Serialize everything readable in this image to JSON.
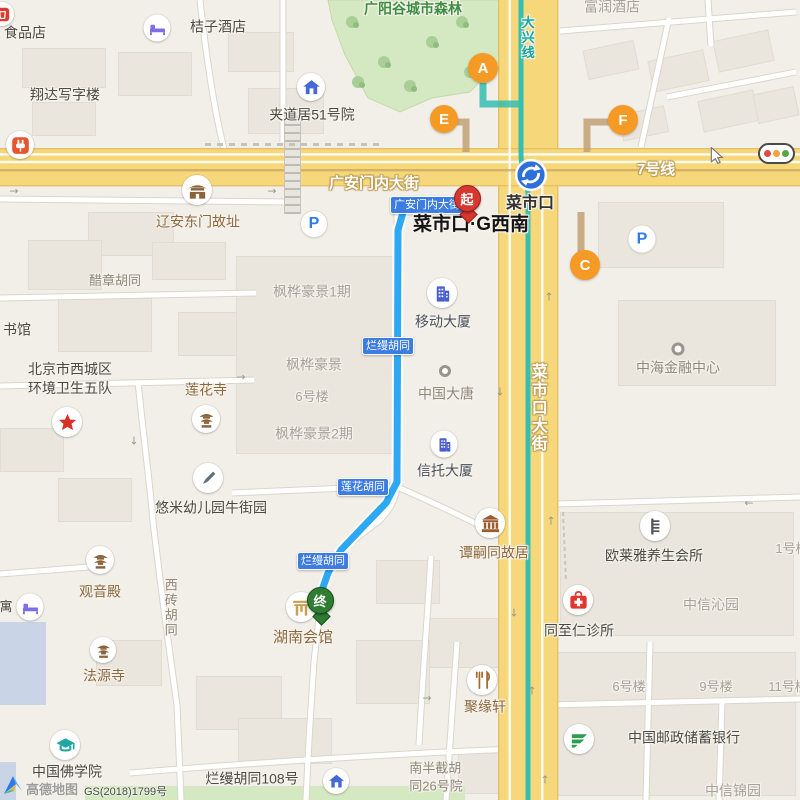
{
  "colors": {
    "road_fill": "#F6D87A",
    "road_edge": "#E5C068",
    "street_fill": "#FFFFFF",
    "street_case": "#DAD6CC",
    "metro_teal": "#2BBDB3",
    "line7_tan": "#C9A463",
    "route_blue": "#2EA8F2",
    "exit_orange": "#F59B25",
    "badge_blue": "#3D7CE0",
    "park_green": "#D4E8C2",
    "start_pin_red": "#D6372E",
    "end_pin_green": "#2E7D32"
  },
  "roads": {
    "h_name": "广安门内大街",
    "v_name": "菜市口大街",
    "line7_label": "7号线",
    "daxing_label": "大兴线"
  },
  "station": {
    "name": "菜市口",
    "label_x": 530,
    "label_y": 204,
    "icon_x": 531,
    "icon_y": 175,
    "icon_d": 33
  },
  "route": {
    "start_pin_label": "起",
    "end_pin_label": "终",
    "start_poi": "菜市口·G西南",
    "end_poi": "湖南会馆",
    "polyline": [
      [
        464,
        211
      ],
      [
        404,
        209
      ],
      [
        398,
        230
      ],
      [
        397,
        482
      ],
      [
        386,
        503
      ],
      [
        362,
        528
      ],
      [
        341,
        550
      ],
      [
        328,
        573
      ],
      [
        321,
        593
      ],
      [
        320,
        603
      ]
    ],
    "pins": [
      {
        "label": "起",
        "x": 467,
        "tip": 221,
        "fill": "#D6372E",
        "edge": "#9E1F16",
        "name": "start-pin"
      },
      {
        "label": "终",
        "x": 320,
        "tip": 623,
        "fill": "#2E7D32",
        "edge": "#175219",
        "name": "end-pin"
      }
    ]
  },
  "badges": [
    {
      "text": "广安门内大街",
      "x": 390,
      "y": 196,
      "w": 70
    },
    {
      "text": "烂缦胡同",
      "x": 362,
      "y": 337,
      "w": 0
    },
    {
      "text": "莲花胡同",
      "x": 337,
      "y": 478,
      "w": 0
    },
    {
      "text": "烂缦胡同",
      "x": 297,
      "y": 552,
      "w": 0
    }
  ],
  "exits": [
    {
      "letter": "A",
      "x": 483,
      "y": 68,
      "d": 30
    },
    {
      "letter": "E",
      "x": 444,
      "y": 119,
      "d": 28
    },
    {
      "letter": "F",
      "x": 623,
      "y": 120,
      "d": 30
    },
    {
      "letter": "C",
      "x": 585,
      "y": 265,
      "d": 30
    }
  ],
  "parkings": [
    {
      "x": 314,
      "y": 224,
      "d": 26
    },
    {
      "x": 642,
      "y": 239,
      "d": 27
    }
  ],
  "labels": [
    {
      "t": "食品店",
      "x": 25,
      "y": 33,
      "c": "dark",
      "s": 14,
      "i": true
    },
    {
      "t": "桔子酒店",
      "x": 218,
      "y": 27,
      "c": "dark",
      "s": 14,
      "i": true
    },
    {
      "t": "翔达写字楼",
      "x": 65,
      "y": 95,
      "c": "dark",
      "s": 14,
      "i": true
    },
    {
      "t": "夹道居51号院",
      "x": 312,
      "y": 115,
      "c": "dark",
      "s": 14,
      "i": true
    },
    {
      "t": "广阳谷城市森林",
      "x": 413,
      "y": 9,
      "c": "green",
      "s": 14,
      "i": true
    },
    {
      "t": "富润酒店",
      "x": 612,
      "y": 7,
      "c": "light",
      "s": 14,
      "i": true
    },
    {
      "t": "辽安东门故址",
      "x": 198,
      "y": 222,
      "c": "brown",
      "s": 14,
      "i": true
    },
    {
      "t": "醋章胡同",
      "x": 115,
      "y": 281,
      "c": "warm",
      "s": 13,
      "i": false
    },
    {
      "t": "书馆",
      "x": 17,
      "y": 330,
      "c": "dark",
      "s": 14,
      "i": true
    },
    {
      "t": "北京市西城区\n环境卫生五队",
      "x": 70,
      "y": 379,
      "c": "dark",
      "s": 14,
      "i": true
    },
    {
      "t": "莲花寺",
      "x": 206,
      "y": 390,
      "c": "brown",
      "s": 14,
      "i": true
    },
    {
      "t": "枫桦豪景1期",
      "x": 312,
      "y": 292,
      "c": "light",
      "s": 14,
      "i": true
    },
    {
      "t": "移动大厦",
      "x": 443,
      "y": 322,
      "c": "slate",
      "s": 14,
      "i": true
    },
    {
      "t": "枫桦豪景",
      "x": 314,
      "y": 365,
      "c": "light",
      "s": 14,
      "i": true
    },
    {
      "t": "6号楼",
      "x": 312,
      "y": 397,
      "c": "light",
      "s": 13,
      "i": false
    },
    {
      "t": "中国大唐",
      "x": 446,
      "y": 394,
      "c": "warm",
      "s": 14,
      "i": true
    },
    {
      "t": "枫桦豪景2期",
      "x": 314,
      "y": 434,
      "c": "light",
      "s": 14,
      "i": true
    },
    {
      "t": "信托大厦",
      "x": 445,
      "y": 471,
      "c": "slate",
      "s": 14,
      "i": true
    },
    {
      "t": "中海金融中心",
      "x": 678,
      "y": 368,
      "c": "warm",
      "s": 14,
      "i": true
    },
    {
      "t": "悠米幼儿园牛街园",
      "x": 211,
      "y": 508,
      "c": "dark",
      "s": 14,
      "i": true
    },
    {
      "t": "谭嗣同故居",
      "x": 494,
      "y": 553,
      "c": "brown",
      "s": 14,
      "i": true
    },
    {
      "t": "欧莱雅养生会所",
      "x": 654,
      "y": 556,
      "c": "dark",
      "s": 14,
      "i": true
    },
    {
      "t": "同至仁诊所",
      "x": 579,
      "y": 631,
      "c": "dark",
      "s": 14,
      "i": true
    },
    {
      "t": "中信沁园",
      "x": 711,
      "y": 605,
      "c": "light",
      "s": 14,
      "i": true
    },
    {
      "t": "观音殿",
      "x": 100,
      "y": 592,
      "c": "brown",
      "s": 14,
      "i": true
    },
    {
      "t": "法源寺",
      "x": 104,
      "y": 676,
      "c": "brown",
      "s": 14,
      "i": true
    },
    {
      "t": "寓",
      "x": 6,
      "y": 607,
      "c": "dark",
      "s": 13,
      "i": true
    },
    {
      "t": "湖南会馆",
      "x": 303,
      "y": 638,
      "c": "brown",
      "s": 15,
      "i": true
    },
    {
      "t": "聚缘轩",
      "x": 485,
      "y": 707,
      "c": "brown",
      "s": 14,
      "i": true
    },
    {
      "t": "6号楼",
      "x": 629,
      "y": 687,
      "c": "light",
      "s": 13,
      "i": false
    },
    {
      "t": "9号楼",
      "x": 716,
      "y": 687,
      "c": "light",
      "s": 13,
      "i": false
    },
    {
      "t": "11号楼",
      "x": 788,
      "y": 687,
      "c": "light",
      "s": 13,
      "i": false
    },
    {
      "t": "中国邮政储蓄银行",
      "x": 684,
      "y": 738,
      "c": "dark",
      "s": 14,
      "i": true
    },
    {
      "t": "中信锦园",
      "x": 733,
      "y": 791,
      "c": "light",
      "s": 14,
      "i": true
    },
    {
      "t": "中国佛学院",
      "x": 67,
      "y": 772,
      "c": "dark",
      "s": 14,
      "i": true
    },
    {
      "t": "烂缦胡同108号",
      "x": 252,
      "y": 779,
      "c": "dark",
      "s": 14,
      "i": true
    },
    {
      "t": "南半截胡\n同26号院",
      "x": 436,
      "y": 777,
      "c": "warm",
      "s": 13,
      "i": false
    },
    {
      "t": "1号楼",
      "x": 792,
      "y": 549,
      "c": "light",
      "s": 13,
      "i": false
    },
    {
      "t": "西砖胡同",
      "x": 170,
      "y": 608,
      "c": "warm",
      "s": 13,
      "v": true,
      "i": false
    },
    {
      "t": "菜市口·G西南",
      "x": 471,
      "y": 225,
      "c": "black",
      "s": 19,
      "i": true
    },
    {
      "t": "菜市口",
      "x": 530,
      "y": 204,
      "c": "station",
      "s": 16,
      "i": true
    },
    {
      "t": "广安门内大街",
      "x": 374,
      "y": 184,
      "c": "roadwhite",
      "s": 15,
      "i": false
    },
    {
      "t": "7号线",
      "x": 656,
      "y": 170,
      "c": "roadwhite",
      "s": 15,
      "i": false
    },
    {
      "t": "菜市口大街",
      "x": 537,
      "y": 408,
      "c": "roadwhite",
      "s": 16,
      "v": true,
      "i": false
    },
    {
      "t": "大兴线",
      "x": 527,
      "y": 38,
      "c": "teal",
      "s": 13,
      "v": true,
      "i": false
    }
  ],
  "icons": [
    {
      "t": "shopred",
      "x": 2,
      "y": 14,
      "d": 24
    },
    {
      "t": "bed",
      "x": 157,
      "y": 28,
      "d": 27
    },
    {
      "t": "houseblue",
      "x": 311,
      "y": 87,
      "d": 28
    },
    {
      "t": "plug",
      "x": 20,
      "y": 145,
      "d": 28
    },
    {
      "t": "gate",
      "x": 197,
      "y": 190,
      "d": 30
    },
    {
      "t": "building",
      "x": 442,
      "y": 293,
      "d": 30
    },
    {
      "t": "building",
      "x": 444,
      "y": 444,
      "d": 27
    },
    {
      "t": "dot",
      "x": 445,
      "y": 371,
      "d": 12
    },
    {
      "t": "dot",
      "x": 678,
      "y": 349,
      "d": 13
    },
    {
      "t": "star",
      "x": 67,
      "y": 422,
      "d": 30
    },
    {
      "t": "pagoda",
      "x": 206,
      "y": 419,
      "d": 28
    },
    {
      "t": "pencil",
      "x": 208,
      "y": 478,
      "d": 30
    },
    {
      "t": "pagoda",
      "x": 100,
      "y": 560,
      "d": 28
    },
    {
      "t": "bed",
      "x": 30,
      "y": 607,
      "d": 27
    },
    {
      "t": "pagoda",
      "x": 103,
      "y": 650,
      "d": 26
    },
    {
      "t": "paifang",
      "x": 301,
      "y": 607,
      "d": 30
    },
    {
      "t": "museum",
      "x": 490,
      "y": 523,
      "d": 30
    },
    {
      "t": "comb",
      "x": 655,
      "y": 526,
      "d": 30
    },
    {
      "t": "medical",
      "x": 578,
      "y": 600,
      "d": 30
    },
    {
      "t": "restaurant",
      "x": 482,
      "y": 680,
      "d": 30
    },
    {
      "t": "post",
      "x": 579,
      "y": 739,
      "d": 30
    },
    {
      "t": "gradcap",
      "x": 65,
      "y": 745,
      "d": 30
    },
    {
      "t": "houseblue",
      "x": 336,
      "y": 781,
      "d": 26
    }
  ],
  "arrows": [
    {
      "x": 14,
      "y": 191,
      "g": "→"
    },
    {
      "x": 272,
      "y": 191,
      "g": "→"
    },
    {
      "x": 241,
      "y": 377,
      "g": "→"
    },
    {
      "x": 134,
      "y": 441,
      "g": "↓"
    },
    {
      "x": 549,
      "y": 297,
      "g": "↑"
    },
    {
      "x": 500,
      "y": 392,
      "g": "↓"
    },
    {
      "x": 514,
      "y": 613,
      "g": "↓"
    },
    {
      "x": 551,
      "y": 521,
      "g": "↑"
    },
    {
      "x": 427,
      "y": 698,
      "g": "→"
    },
    {
      "x": 532,
      "y": 691,
      "g": "↑"
    },
    {
      "x": 545,
      "y": 780,
      "g": "↑"
    },
    {
      "x": 749,
      "y": 503,
      "g": "←"
    }
  ],
  "geometry": {
    "h_road": {
      "y": 149,
      "h": 36
    },
    "v_road": {
      "x": 499,
      "w": 58
    },
    "metro_line_d": "M521,0 L521,155 C521,172 528,178 528,195 L528,800",
    "line7_y": 169,
    "connectors": [
      {
        "d": "M446,122 H466 V152",
        "c": "tan"
      },
      {
        "d": "M620,122 H587 V152",
        "c": "tan"
      },
      {
        "d": "M581,212 V252",
        "c": "tan"
      },
      {
        "d": "M483,70 V104 H519",
        "c": "teal"
      }
    ],
    "streets": [
      "M200,0 C206,55 213,105 224,149",
      "M283,0 L283,142",
      "M0,199 L288,202",
      "M0,298 L256,293",
      "M0,386 L254,380",
      "M138,382 C145,450 150,485 153,521 C161,590 170,655 177,705 L181,800",
      "M232,493 L395,486",
      "M395,486 C432,502 472,521 506,539",
      "M397,207 L397,482 C397,499 389,511 379,521 L342,549 C333,560 325,574 322,591 L314,662 C311,705 308,755 306,800",
      "M556,504 L800,497",
      "M548,705 L800,699",
      "M650,642 L646,800",
      "M457,642 L446,800",
      "M560,31 L796,12",
      "M669,18 L641,147",
      "M667,97 L796,72",
      "M708,0 L711,46",
      "M130,773 C260,762 420,752 546,748",
      "M0,574 L89,567",
      "M431,556 C428,610 423,670 419,745",
      "M722,702 L719,800"
    ],
    "streets_dashed": [
      "M563,512 L566,582"
    ],
    "park_poly": "328,0 505,0 505,55 470,92 432,98 400,112 368,98 345,55 332,20",
    "park_trees": [
      [
        352,
        22
      ],
      [
        384,
        62
      ],
      [
        432,
        42
      ],
      [
        462,
        22
      ],
      [
        470,
        72
      ],
      [
        410,
        86
      ],
      [
        358,
        82
      ]
    ],
    "green_strips": [
      {
        "x": 85,
        "y": 786,
        "w": 380,
        "h": 14
      }
    ],
    "water": [
      {
        "x": 0,
        "y": 622,
        "w": 46,
        "h": 83
      },
      {
        "x": 0,
        "y": 762,
        "w": 16,
        "h": 38
      }
    ],
    "blocks": [
      [
        22,
        48,
        82,
        38
      ],
      [
        118,
        52,
        72,
        42
      ],
      [
        32,
        102,
        62,
        32
      ],
      [
        228,
        32,
        64,
        38
      ],
      [
        248,
        88,
        74,
        44
      ],
      [
        88,
        212,
        84,
        42
      ],
      [
        152,
        242,
        72,
        36
      ],
      [
        28,
        240,
        72,
        48
      ],
      [
        58,
        298,
        92,
        52
      ],
      [
        178,
        312,
        62,
        42
      ],
      [
        236,
        256,
        158,
        196
      ],
      [
        560,
        512,
        232,
        122
      ],
      [
        552,
        652,
        242,
        142
      ],
      [
        598,
        202,
        124,
        64
      ],
      [
        618,
        300,
        156,
        84
      ],
      [
        96,
        640,
        64,
        44
      ],
      [
        196,
        676,
        84,
        52
      ],
      [
        376,
        560,
        62,
        42
      ],
      [
        428,
        618,
        72,
        48
      ],
      [
        58,
        478,
        72,
        42
      ],
      [
        0,
        428,
        62,
        42
      ],
      [
        356,
        640,
        72,
        62
      ],
      [
        238,
        718,
        92,
        44
      ],
      [
        458,
        748,
        72,
        44
      ],
      [
        585,
        45,
        50,
        28,
        -12
      ],
      [
        650,
        55,
        55,
        30,
        -12
      ],
      [
        715,
        35,
        55,
        30,
        -12
      ],
      [
        700,
        95,
        55,
        30,
        -12
      ],
      [
        755,
        90,
        40,
        28,
        -12
      ],
      [
        620,
        110,
        45,
        25,
        -12
      ]
    ]
  },
  "attribution": {
    "brand": "高德地图",
    "license": "GS(2018)1799号"
  }
}
